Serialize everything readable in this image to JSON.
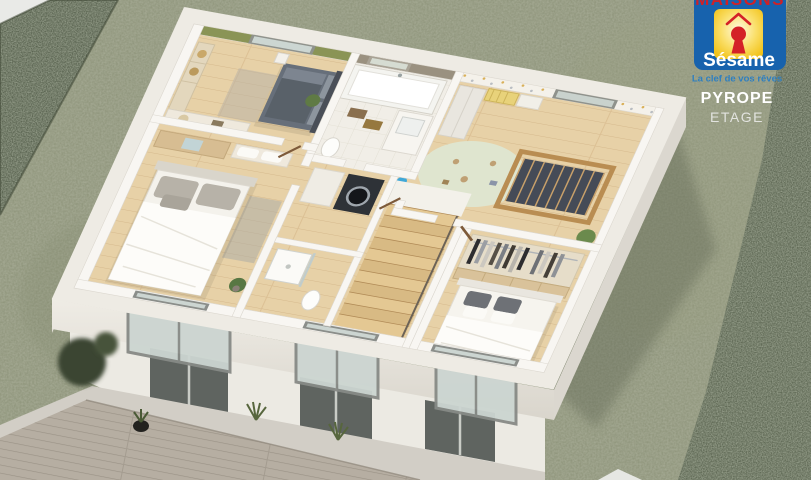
{
  "branding": {
    "brand_top": "MAISONS",
    "brand_name": "Sésame",
    "tagline": "La clef de vos rêves",
    "colors": {
      "logo_background": "#1762ad",
      "logo_square": "#f5c71d",
      "logo_emblem_red": "#d42127",
      "logo_text": "#ffffff",
      "tagline_blue": "#2e7fc0"
    }
  },
  "plan": {
    "model_name": "PYROPE",
    "level": "ETAGE"
  },
  "scene_colors": {
    "lawn": "#8c9278",
    "hedge": "#454f3c",
    "wood_floor": "#e7d1a7",
    "walls": "#f8f6f2",
    "slab": "#eeebe4",
    "deck": "#b6aea2",
    "dark_bed": "#676f7a",
    "white_bed": "#f4f2ec"
  }
}
